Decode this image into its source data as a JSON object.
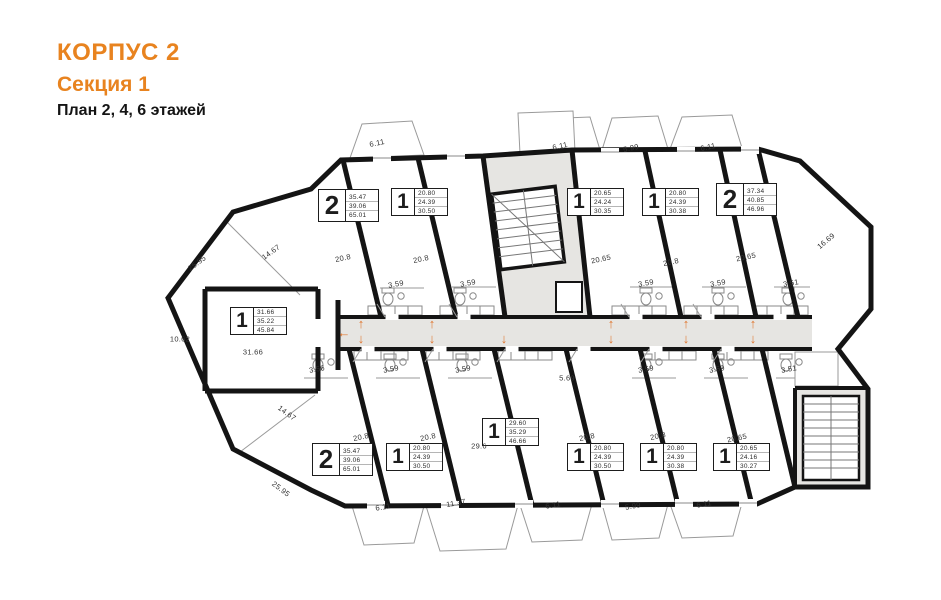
{
  "title": {
    "line1": "КОРПУС 2",
    "line2": "Секция 1",
    "line3": "План 2, 4, 6 этажей"
  },
  "colors": {
    "accent": "#E8831F",
    "arrow": "#E0762F",
    "wall": "#141414",
    "fill_gray": "#E6E5E2",
    "thin_line": "#8a8a8a",
    "dim_text": "#333333"
  },
  "plan": {
    "apartments": [
      {
        "id": "top-1",
        "type": "2",
        "values": [
          "35.47",
          "39.06",
          "65.01"
        ],
        "x": 318,
        "y": 189,
        "big": true
      },
      {
        "id": "top-2",
        "type": "1",
        "values": [
          "20.80",
          "24.39",
          "30.50"
        ],
        "x": 391,
        "y": 188,
        "big": false
      },
      {
        "id": "top-3",
        "type": "1",
        "values": [
          "20.65",
          "24.24",
          "30.35"
        ],
        "x": 567,
        "y": 188,
        "big": false
      },
      {
        "id": "top-4",
        "type": "1",
        "values": [
          "20.80",
          "24.39",
          "30.38"
        ],
        "x": 642,
        "y": 188,
        "big": false
      },
      {
        "id": "top-5",
        "type": "2",
        "values": [
          "37.34",
          "40.85",
          "46.96"
        ],
        "x": 716,
        "y": 183,
        "big": true
      },
      {
        "id": "left-1",
        "type": "1",
        "values": [
          "31.66",
          "35.22",
          "45.84"
        ],
        "x": 230,
        "y": 307,
        "big": false
      },
      {
        "id": "bottom-1",
        "type": "2",
        "values": [
          "35.47",
          "39.06",
          "65.01"
        ],
        "x": 312,
        "y": 443,
        "big": true
      },
      {
        "id": "bottom-2",
        "type": "1",
        "values": [
          "20.80",
          "24.39",
          "30.50"
        ],
        "x": 386,
        "y": 443,
        "big": false
      },
      {
        "id": "bottom-3",
        "type": "1",
        "values": [
          "29.60",
          "35.29",
          "46.66"
        ],
        "x": 482,
        "y": 418,
        "big": false
      },
      {
        "id": "bottom-4",
        "type": "1",
        "values": [
          "20.80",
          "24.39",
          "30.50"
        ],
        "x": 567,
        "y": 443,
        "big": false
      },
      {
        "id": "bottom-5",
        "type": "1",
        "values": [
          "20.80",
          "24.39",
          "30.38"
        ],
        "x": 640,
        "y": 443,
        "big": false
      },
      {
        "id": "bottom-6",
        "type": "1",
        "values": [
          "20.65",
          "24.16",
          "30.27"
        ],
        "x": 713,
        "y": 443,
        "big": false
      }
    ],
    "dimensions": [
      {
        "t": "25.95",
        "x": 197,
        "y": 263,
        "r": -37
      },
      {
        "t": "14.67",
        "x": 271,
        "y": 252,
        "r": -36
      },
      {
        "t": "10.62",
        "x": 180,
        "y": 339,
        "r": 0
      },
      {
        "t": "31.66",
        "x": 253,
        "y": 352,
        "r": 0
      },
      {
        "t": "14.67",
        "x": 287,
        "y": 413,
        "r": 36
      },
      {
        "t": "25.95",
        "x": 281,
        "y": 489,
        "r": 37
      },
      {
        "t": "6.11",
        "x": 377,
        "y": 143,
        "r": -12
      },
      {
        "t": "6.11",
        "x": 560,
        "y": 146,
        "r": -12
      },
      {
        "t": "5.99",
        "x": 631,
        "y": 148,
        "r": -12
      },
      {
        "t": "6.11",
        "x": 708,
        "y": 147,
        "r": -12
      },
      {
        "t": "16.69",
        "x": 826,
        "y": 241,
        "r": -40
      },
      {
        "t": "20.8",
        "x": 343,
        "y": 258,
        "r": -12
      },
      {
        "t": "20.8",
        "x": 421,
        "y": 259,
        "r": -12
      },
      {
        "t": "20.65",
        "x": 601,
        "y": 259,
        "r": -12
      },
      {
        "t": "20.8",
        "x": 671,
        "y": 262,
        "r": -12
      },
      {
        "t": "20.65",
        "x": 746,
        "y": 257,
        "r": -12
      },
      {
        "t": "3.59",
        "x": 396,
        "y": 284,
        "r": -10
      },
      {
        "t": "3.59",
        "x": 468,
        "y": 283,
        "r": -10
      },
      {
        "t": "3.59",
        "x": 646,
        "y": 283,
        "r": -10
      },
      {
        "t": "3.59",
        "x": 718,
        "y": 283,
        "r": -10
      },
      {
        "t": "3.51",
        "x": 791,
        "y": 283,
        "r": -10
      },
      {
        "t": "3.56",
        "x": 317,
        "y": 369,
        "r": -10
      },
      {
        "t": "3.59",
        "x": 391,
        "y": 369,
        "r": -10
      },
      {
        "t": "3.59",
        "x": 463,
        "y": 369,
        "r": -10
      },
      {
        "t": "5.69",
        "x": 567,
        "y": 378,
        "r": 0
      },
      {
        "t": "3.59",
        "x": 646,
        "y": 369,
        "r": -10
      },
      {
        "t": "3.59",
        "x": 717,
        "y": 369,
        "r": -10
      },
      {
        "t": "3.51",
        "x": 789,
        "y": 369,
        "r": -10
      },
      {
        "t": "20.8",
        "x": 361,
        "y": 437,
        "r": -12
      },
      {
        "t": "20.8",
        "x": 428,
        "y": 437,
        "r": -12
      },
      {
        "t": "29.6",
        "x": 479,
        "y": 446,
        "r": 0
      },
      {
        "t": "20.8",
        "x": 587,
        "y": 437,
        "r": -12
      },
      {
        "t": "20.8",
        "x": 658,
        "y": 436,
        "r": -12
      },
      {
        "t": "20.65",
        "x": 737,
        "y": 438,
        "r": -12
      },
      {
        "t": "6.11",
        "x": 383,
        "y": 507,
        "r": -10
      },
      {
        "t": "11.37",
        "x": 456,
        "y": 503,
        "r": -10
      },
      {
        "t": "6.11",
        "x": 553,
        "y": 505,
        "r": -10
      },
      {
        "t": "5.99",
        "x": 633,
        "y": 506,
        "r": -10
      },
      {
        "t": "6.11",
        "x": 704,
        "y": 504,
        "r": -10
      }
    ],
    "arrows": [
      {
        "d": "left",
        "x": 344,
        "y": 326
      },
      {
        "d": "up",
        "x": 361,
        "y": 317
      },
      {
        "d": "down",
        "x": 361,
        "y": 332
      },
      {
        "d": "up",
        "x": 432,
        "y": 317
      },
      {
        "d": "down",
        "x": 432,
        "y": 332
      },
      {
        "d": "down",
        "x": 504,
        "y": 332
      },
      {
        "d": "up",
        "x": 611,
        "y": 317
      },
      {
        "d": "down",
        "x": 611,
        "y": 332
      },
      {
        "d": "up",
        "x": 686,
        "y": 317
      },
      {
        "d": "down",
        "x": 686,
        "y": 332
      },
      {
        "d": "up",
        "x": 753,
        "y": 317
      },
      {
        "d": "down",
        "x": 753,
        "y": 332
      }
    ]
  }
}
